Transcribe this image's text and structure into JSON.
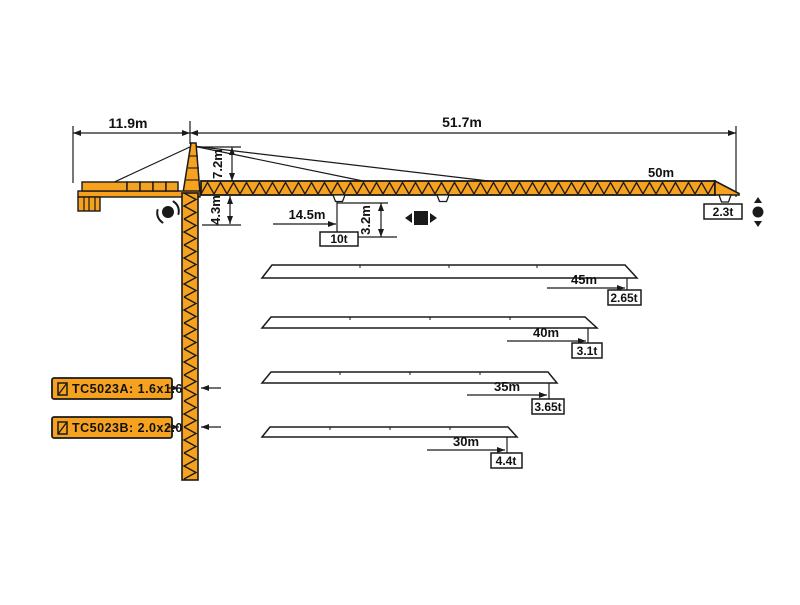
{
  "dimensions": {
    "counter_jib": "11.9m",
    "main_jib_span": "51.7m",
    "tower_head": "7.2m",
    "jib_to_mark": "4.3m",
    "hook_drop": "3.2m",
    "radius_max_load": "14.5m",
    "max_capacity": "10t"
  },
  "main_jib": {
    "length": "50m",
    "tip_load": "2.3t"
  },
  "jib_variants": [
    {
      "length": "45m",
      "tip_load": "2.65t"
    },
    {
      "length": "40m",
      "tip_load": "3.1t"
    },
    {
      "length": "35m",
      "tip_load": "3.65t"
    },
    {
      "length": "30m",
      "tip_load": "4.4t"
    }
  ],
  "models": [
    {
      "name": "TC5023A",
      "mast_section": "1.6x1.6",
      "label": "TC5023A: 1.6x1.6"
    },
    {
      "name": "TC5023B",
      "mast_section": "2.0x2.0",
      "label": "TC5023B: 2.0x2.0"
    }
  ],
  "colors": {
    "crane_orange": "#F6A21F",
    "line_black": "#1A1A1A",
    "background": "#FFFFFF"
  }
}
